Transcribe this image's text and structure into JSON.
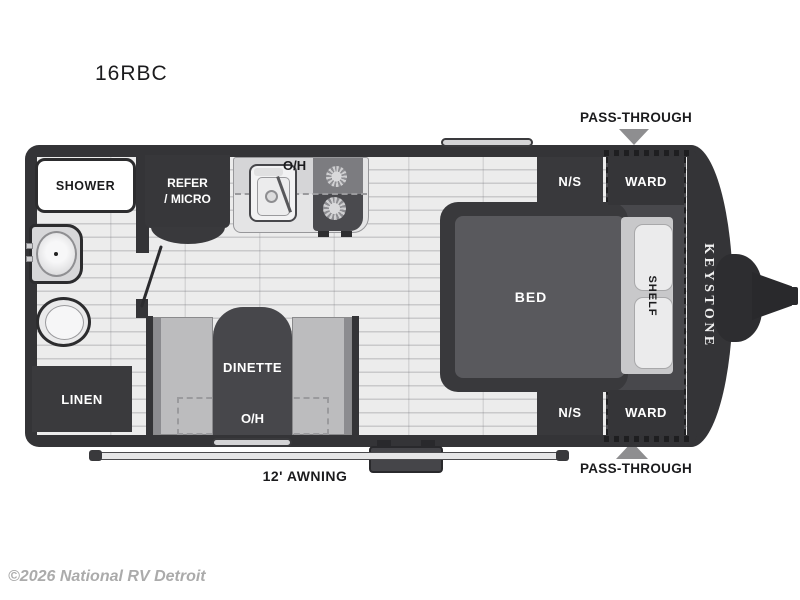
{
  "title": "16RBC",
  "watermark": "©2026 National RV Detroit",
  "brand_logo": "KEYSTONE",
  "annotations": {
    "pass_through_top": "PASS-THROUGH",
    "pass_through_bottom": "PASS-THROUGH",
    "awning": "12' AWNING"
  },
  "rooms": {
    "shower": "SHOWER",
    "refer_line1": "REFER",
    "refer_line2": "/ MICRO",
    "kitchen_overhead": "O/H",
    "linen": "LINEN",
    "dinette": "DINETTE",
    "dinette_overhead": "O/H",
    "bed": "BED",
    "shelf": "SHELF",
    "nightstand_top": "N/S",
    "nightstand_bottom": "N/S",
    "wardrobe_top": "WARD",
    "wardrobe_bottom": "WARD"
  },
  "colors": {
    "wall": "#343437",
    "cabinet": "#39393c",
    "floor": "#ececec",
    "mattress": "#59595d",
    "arrow_gray": "#8e8e90",
    "watermark_gray": "#ababab",
    "label_text": "#ffffff"
  }
}
